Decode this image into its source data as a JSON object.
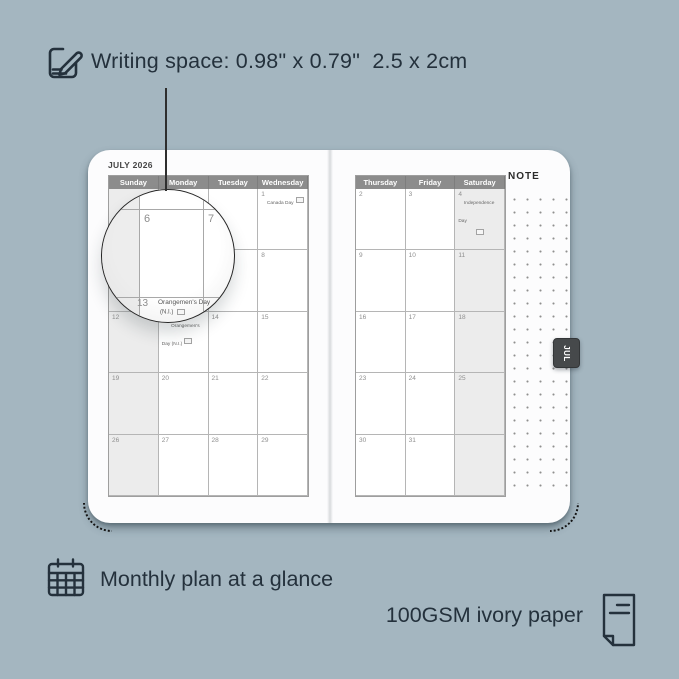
{
  "colors": {
    "background": "#a4b6c0",
    "ink": "#24313c",
    "page": "#fcfcfd",
    "header_bg": "#8c8c8c",
    "header_text": "#ffffff",
    "grid_line": "#b5b5b5",
    "shaded_cell": "#ececec",
    "day_number": "#8f8f8f",
    "holiday_text": "#666666",
    "tab_bg": "#46494b",
    "tab_text": "#ffffff",
    "stitch": "#141414"
  },
  "annotations": {
    "writing_space": "Writing space: 0.98\" x 0.79\"  2.5 x 2cm",
    "monthly_plan": "Monthly plan at a glance",
    "paper_quality": "100GSM ivory paper"
  },
  "icons": {
    "top_left": "pencil-note-icon",
    "bottom_left": "calendar-grid-icon",
    "bottom_right": "paper-sheet-icon"
  },
  "planner": {
    "month_title": "JULY 2026",
    "month_tab": "JUL",
    "note_label": "NOTE",
    "left_page": {
      "headers": [
        "Sunday",
        "Monday",
        "Tuesday",
        "Wednesday"
      ],
      "shaded_column": "Sunday",
      "rows": [
        [
          {},
          {},
          {},
          {
            "day": "1",
            "holiday": "Canada Day",
            "flag": "inline"
          }
        ],
        [
          {
            "day": "5"
          },
          {
            "day": "6"
          },
          {
            "day": "7"
          },
          {
            "day": "8"
          }
        ],
        [
          {
            "day": "12"
          },
          {
            "day": "13",
            "holiday": "Orangemen's Day (N.I.)",
            "flag": "inline"
          },
          {
            "day": "14"
          },
          {
            "day": "15"
          }
        ],
        [
          {
            "day": "19"
          },
          {
            "day": "20"
          },
          {
            "day": "21"
          },
          {
            "day": "22"
          }
        ],
        [
          {
            "day": "26"
          },
          {
            "day": "27"
          },
          {
            "day": "28"
          },
          {
            "day": "29"
          }
        ]
      ]
    },
    "right_page": {
      "headers": [
        "Thursday",
        "Friday",
        "Saturday"
      ],
      "shaded_column": "Saturday",
      "rows": [
        [
          {
            "day": "2"
          },
          {
            "day": "3"
          },
          {
            "day": "4",
            "holiday": "Independence Day",
            "flag": "below"
          }
        ],
        [
          {
            "day": "9"
          },
          {
            "day": "10"
          },
          {
            "day": "11"
          }
        ],
        [
          {
            "day": "16"
          },
          {
            "day": "17"
          },
          {
            "day": "18"
          }
        ],
        [
          {
            "day": "23"
          },
          {
            "day": "24"
          },
          {
            "day": "25"
          }
        ],
        [
          {
            "day": "30"
          },
          {
            "day": "31"
          },
          {}
        ]
      ]
    },
    "magnifier": {
      "top_left_day": "6",
      "top_right_day": "7",
      "bottom_day": "13",
      "holiday_name": "Orangemen's Day",
      "holiday_region": "(N.I.)"
    }
  }
}
